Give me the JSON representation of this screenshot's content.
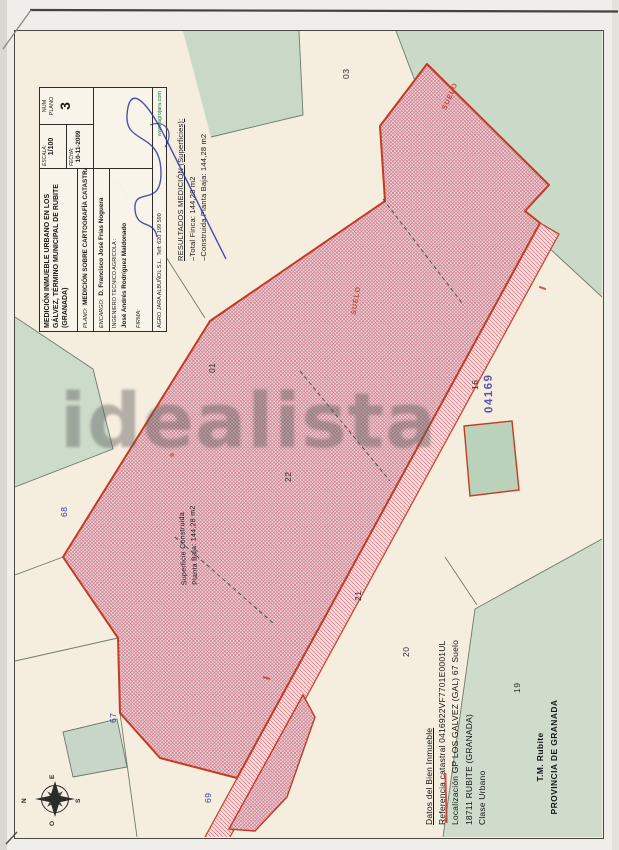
{
  "watermark": "idealista",
  "title_block": {
    "title": "MEDICIÓN INMUEBLE URBANO EN LOS GÁLVEZ, TÉRMINO MUNICIPAL DE RUBITE (GRANADA)",
    "plano_label": "PLANO:",
    "plano_value": "MEDICIÓN SOBRE CARTOGRAFÍA CATASTRAL",
    "encargo_label": "ENCARGO:",
    "encargo_value": "D. Francisco José Frías Noguera",
    "ingeniero_label": "INGENIERO TECNICO AGRICOLA :",
    "ingeniero_value": "José Andrés Rodríguez Maldonado",
    "firma_label": "FIRMA:",
    "escala_label": "ESCALA:",
    "escala_value": "1/100",
    "fecha_label": "FECHA:",
    "fecha_value": "10-11-2009",
    "num_label_1": "NUM",
    "num_label_2": "PLANO",
    "num_value": "3",
    "footer_company": "AGRO JARA ALBUÑOL S.L.",
    "footer_phone": "Telf: 620 199 590",
    "footer_web": "www.agrojara.com"
  },
  "resultados": {
    "heading": "RESULTADOS MEDICIÓN (Superficies):",
    "total": "–Total Finca: 144,28 m2",
    "construida": "–Construida Planta Baja: 144,28 m2"
  },
  "superficie_label": {
    "line1": "Superficie Construida",
    "line2": "Planta Baja: 144,28 m2"
  },
  "datos": {
    "heading": "Datos del Bien Inmueble",
    "referencia": "Referencia catastral 0416922VF7701E0001UL",
    "localizacion": "Localización GP LOS GALVEZ (GAL) 67 Suelo",
    "municipio": "18711 RUBITE (GRANADA)",
    "clase": "Clase Urbano"
  },
  "municipio_block": {
    "line1": "T.M. Rubite",
    "line2": "PROVINCIA DE GRANADA"
  },
  "map": {
    "suelo_label_upper": "SUELO",
    "suelo_label_mid": "SUELO",
    "stamp": "04169",
    "parcel_numbers": {
      "p03": "03",
      "p01": "01",
      "p16": "16",
      "p22": "22",
      "p21": "21",
      "p20": "20",
      "p19": "19"
    },
    "blue_numbers": {
      "b67": "67",
      "b68": "68",
      "b69": "69"
    },
    "compass": {
      "n": "N",
      "e": "E",
      "s": "S",
      "o": "O"
    }
  },
  "colors": {
    "parcel_outline_red": "#c43a23",
    "hatch_red": "#ba465c",
    "paper_cream": "#f5edde",
    "map_green": "#cbd9c8",
    "stamp_blue": "#4a43ae",
    "handwriting_blue": "#35439e",
    "web_link_green": "#1e7a3c"
  }
}
